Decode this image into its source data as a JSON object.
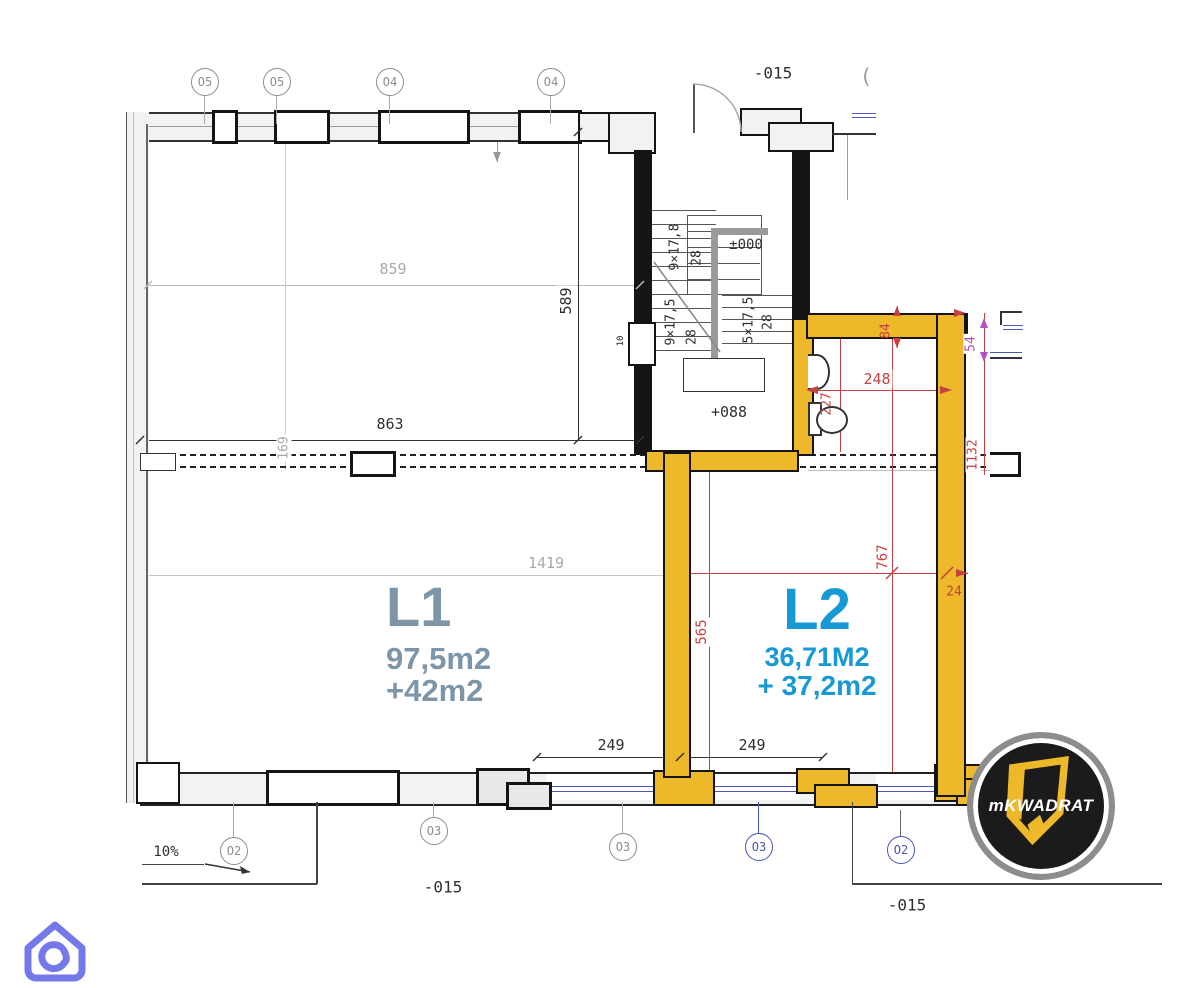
{
  "markers": {
    "top": [
      {
        "label": "O5"
      },
      {
        "label": "O5"
      },
      {
        "label": "O4"
      },
      {
        "label": "O4"
      }
    ],
    "top_partial": "(",
    "bottom": [
      {
        "label": "O2"
      },
      {
        "label": "O3"
      },
      {
        "label": "O3"
      },
      {
        "label": "O3"
      },
      {
        "label": "O2"
      }
    ]
  },
  "levels": {
    "top": "-015",
    "bottom_left": "-015",
    "bottom_right": "-015",
    "ground": "±000",
    "landing": "+088"
  },
  "units": {
    "l1": {
      "name": "L1",
      "area": "97,5m2",
      "bonus": "+42m2"
    },
    "l2": {
      "name": "L2",
      "area": "36,71M2",
      "bonus": "+ 37,2m2"
    }
  },
  "dims": {
    "top_width": "859",
    "mid_width": "863",
    "left_height": "589",
    "wall_offset": "169",
    "total_width": "1419",
    "corridor_height": "565",
    "win_left": "249",
    "win_right": "249",
    "bath_width": "248",
    "bath_offset": "84",
    "side_window": "54",
    "right_height": "1132",
    "l2_height": "767",
    "wall_thickness": "24",
    "wc_offset": "227",
    "window_mark": "10",
    "ramp_slope": "10%"
  },
  "stairs": {
    "flight_a": "9×17,5",
    "flight_b": "9×17,8",
    "flight_c": "5×17,5",
    "tread_a": "28",
    "tread_b": "28",
    "tread_c": "28"
  },
  "logo": {
    "prefix": "m",
    "name": "KWADRAT"
  },
  "colors": {
    "wall_yellow": "#edb829",
    "dim_red": "#c64141",
    "dim_purple": "#b14fc4",
    "unit_l1": "#7d95a8",
    "unit_l2": "#1799d5",
    "marker_blue": "#4a55b5"
  }
}
